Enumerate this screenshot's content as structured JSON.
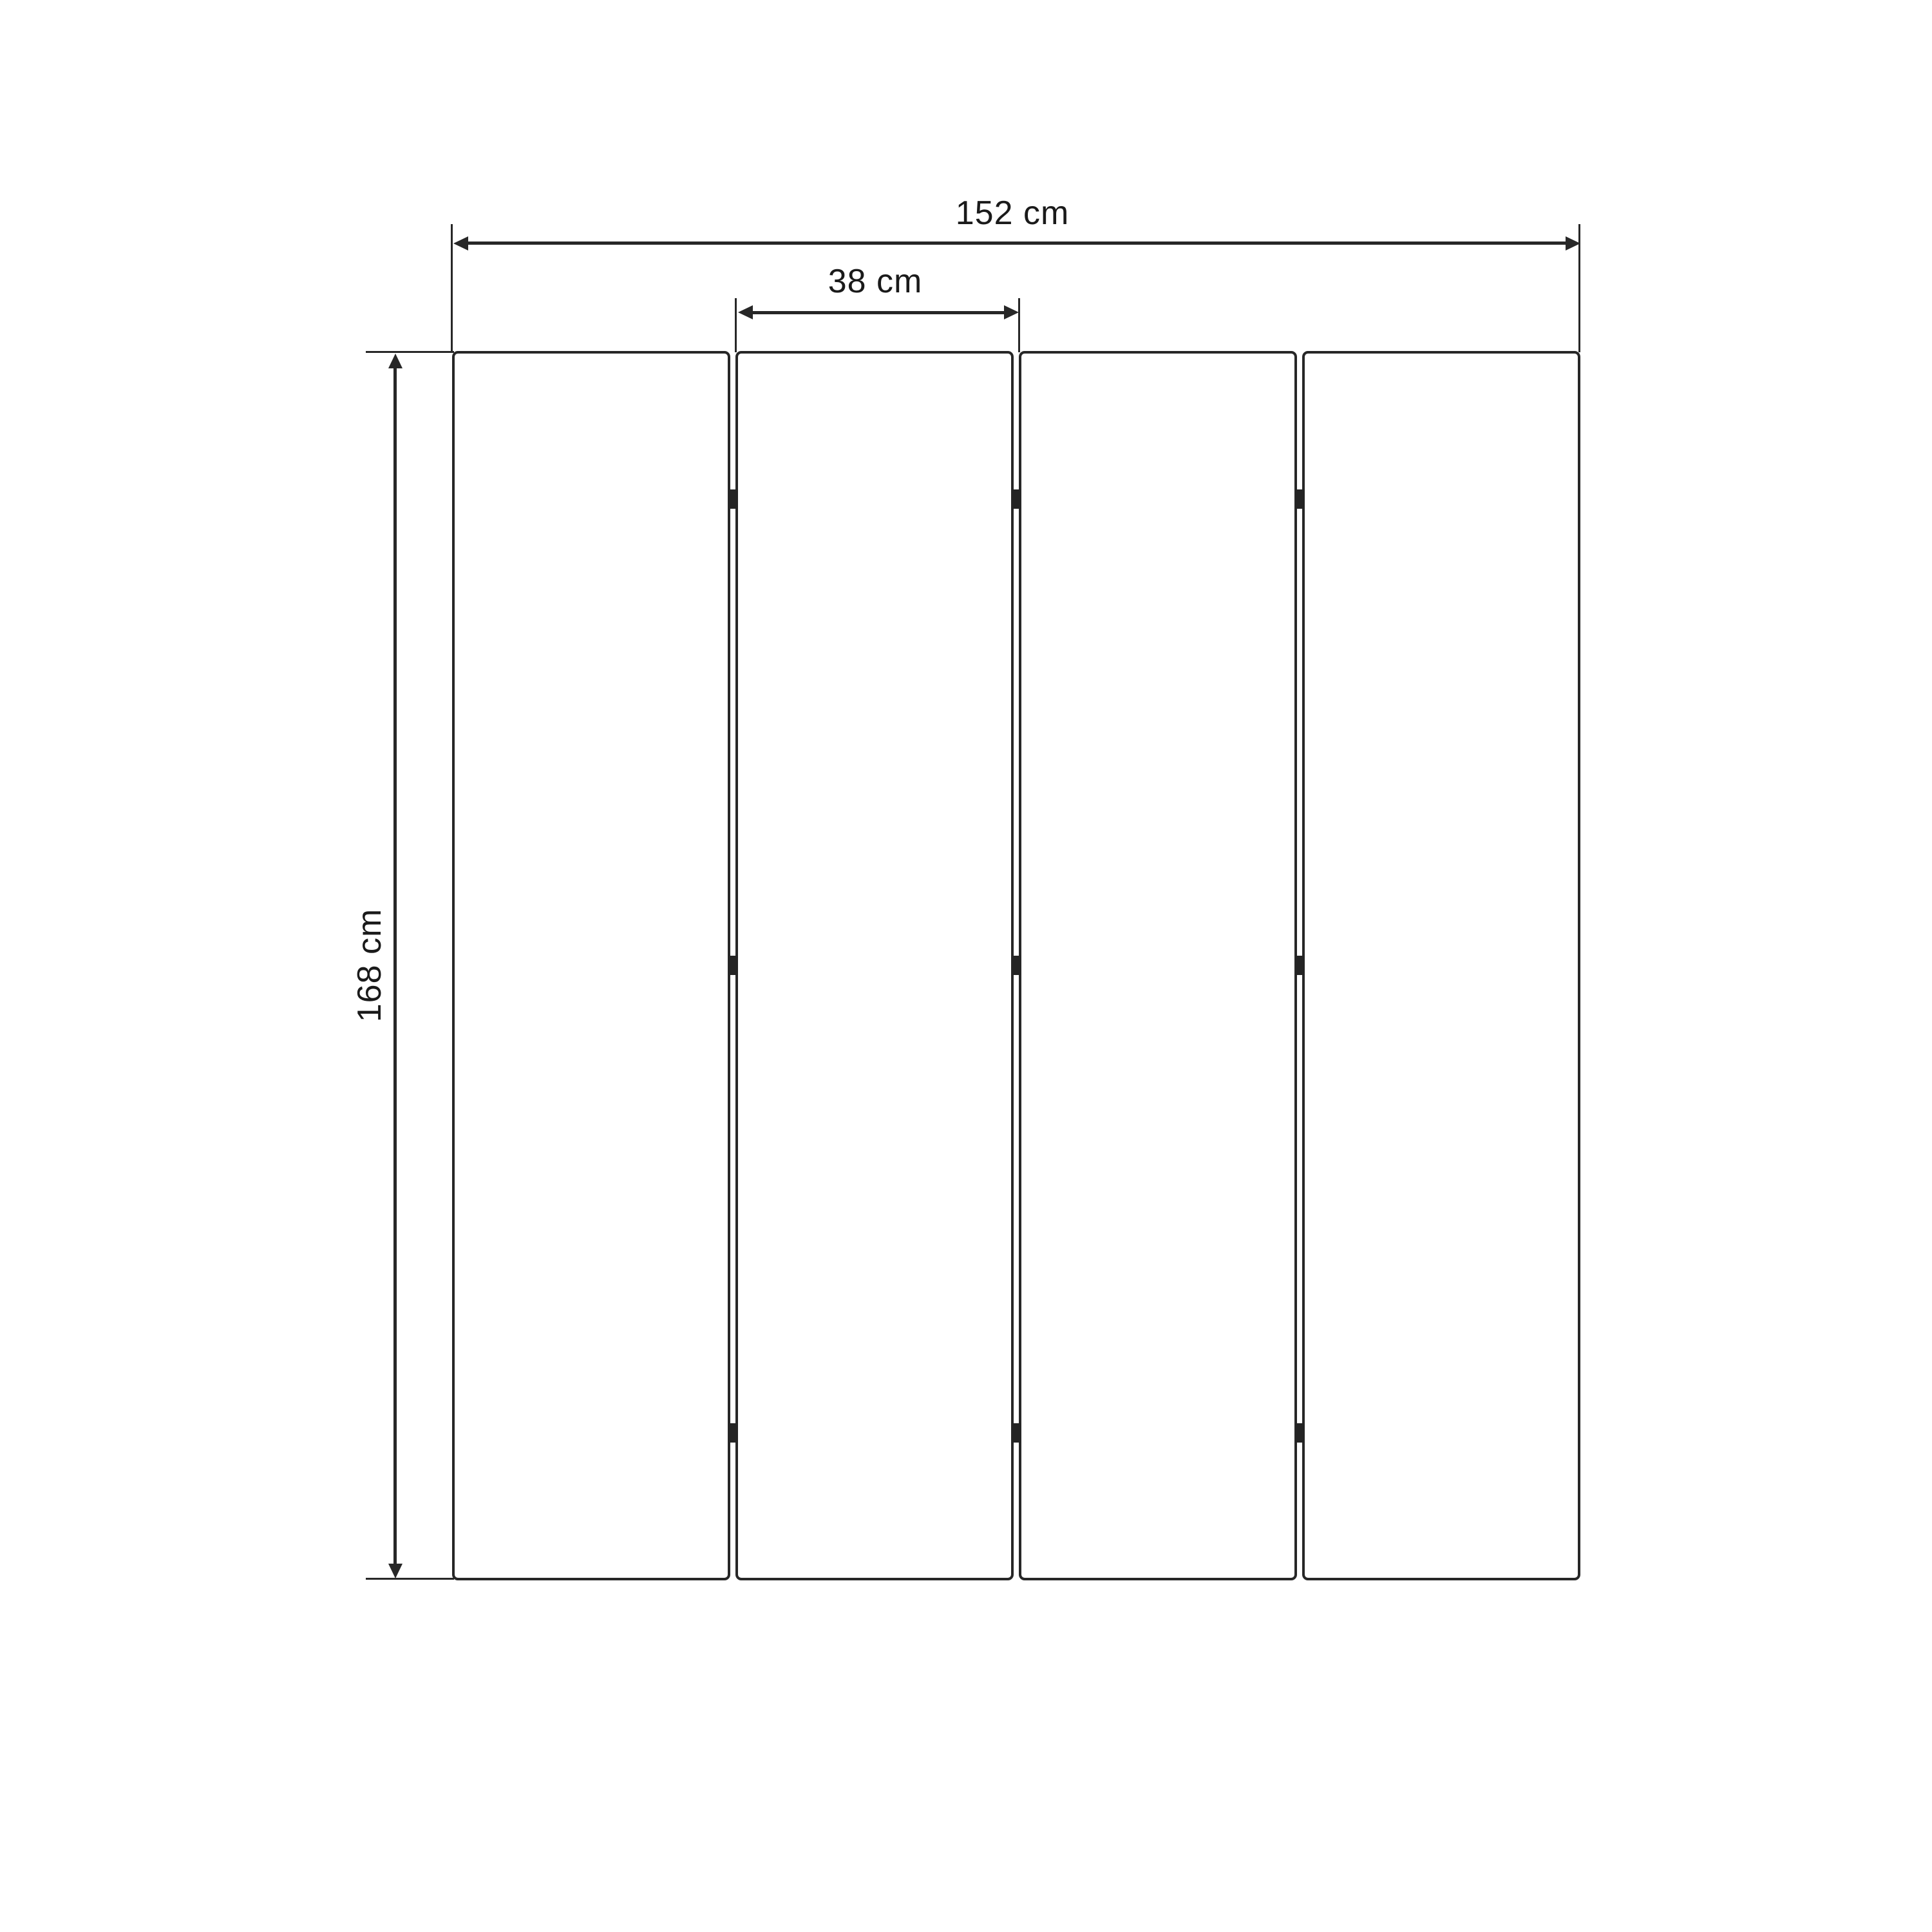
{
  "diagram": {
    "type": "folding-screen-dimension-drawing",
    "labels": {
      "total_width": "152 cm",
      "panel_width": "38 cm",
      "height": "168 cm"
    },
    "values": {
      "total_width_cm": 152,
      "panel_width_cm": 38,
      "height_cm": 168,
      "unit": "cm",
      "panel_count": 4,
      "hinge_columns": 3,
      "hinge_rows": 3
    },
    "colors": {
      "background": "#ffffff",
      "stroke": "#272727",
      "hinge": "#242424",
      "text": "#1a1a1a"
    }
  }
}
